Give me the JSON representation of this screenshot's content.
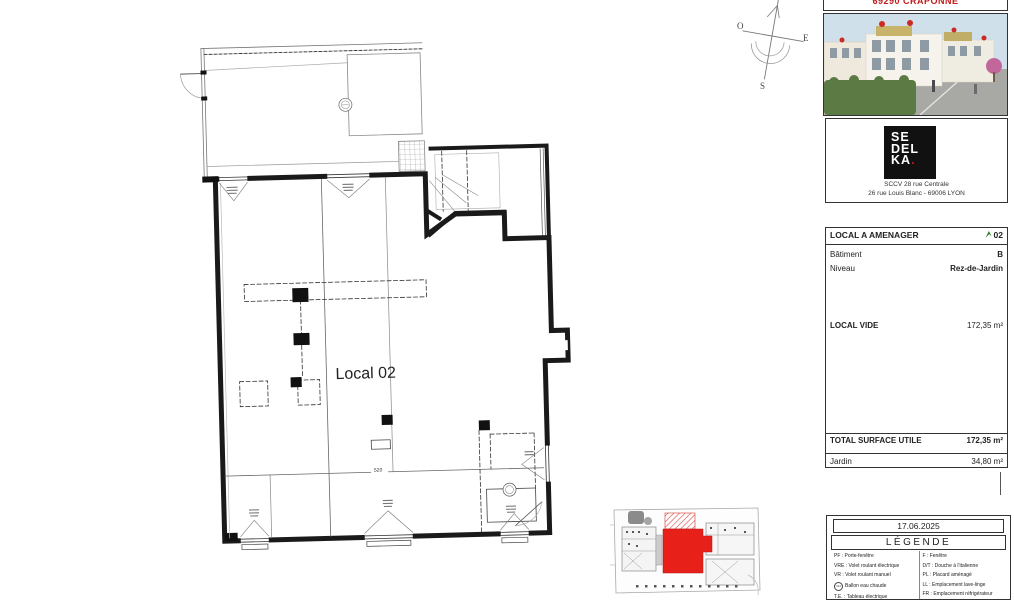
{
  "title_block": {
    "project_location": "69290 CRAPONNE",
    "developer": {
      "logo_line1": "SE",
      "logo_line2": "DEL",
      "logo_line3": "KA",
      "logo_dot": ".",
      "company_line1": "SCCV 28 rue Centrale",
      "company_line2": "26 rue Louis Blanc - 69006 LYON"
    },
    "info": {
      "header_label": "LOCAL A AMENAGER",
      "header_value": "02",
      "batiment_label": "Bâtiment",
      "batiment_value": "B",
      "niveau_label": "Niveau",
      "niveau_value": "Rez-de-Jardin",
      "local_vide_label": "LOCAL VIDE",
      "local_vide_value": "172,35 m²",
      "total_label": "TOTAL SURFACE UTILE",
      "total_value": "172,35 m²",
      "jardin_label": "Jardin",
      "jardin_value": "34,80 m²"
    },
    "date": "17.06.2025",
    "legend": {
      "title": "LÉGENDE",
      "left": [
        {
          "text": "PF : Porte-fenêtre"
        },
        {
          "text": "VRE : Volet roulant électrique"
        },
        {
          "text": "VR : Volet roulant manuel"
        },
        {
          "icon": "CH",
          "text": "Ballon eau chaude"
        },
        {
          "text": "T.E. : Tableau électrique"
        },
        {
          "icon": "rail",
          "text": "Sèche-serviette"
        }
      ],
      "right": [
        {
          "text": "F : Fenêtre"
        },
        {
          "text": "D/T : Douche à l'italienne"
        },
        {
          "text": "PL : Placard aménagé"
        },
        {
          "text": "LL : Emplacement lave-linge"
        },
        {
          "text": "FR : Emplacement réfrigérateur"
        },
        {
          "text": "LV : Emplacement lave-vaisselle"
        }
      ]
    }
  },
  "plan": {
    "unit_label": "Local 02",
    "dimension": "520",
    "compass": {
      "west": "O",
      "east": "E",
      "south": "S"
    }
  },
  "colors": {
    "wall": "#1a1a1a",
    "accent_red": "#e8201a",
    "brand_red": "#c21a1a",
    "legend_green": "#1e7a1e"
  }
}
